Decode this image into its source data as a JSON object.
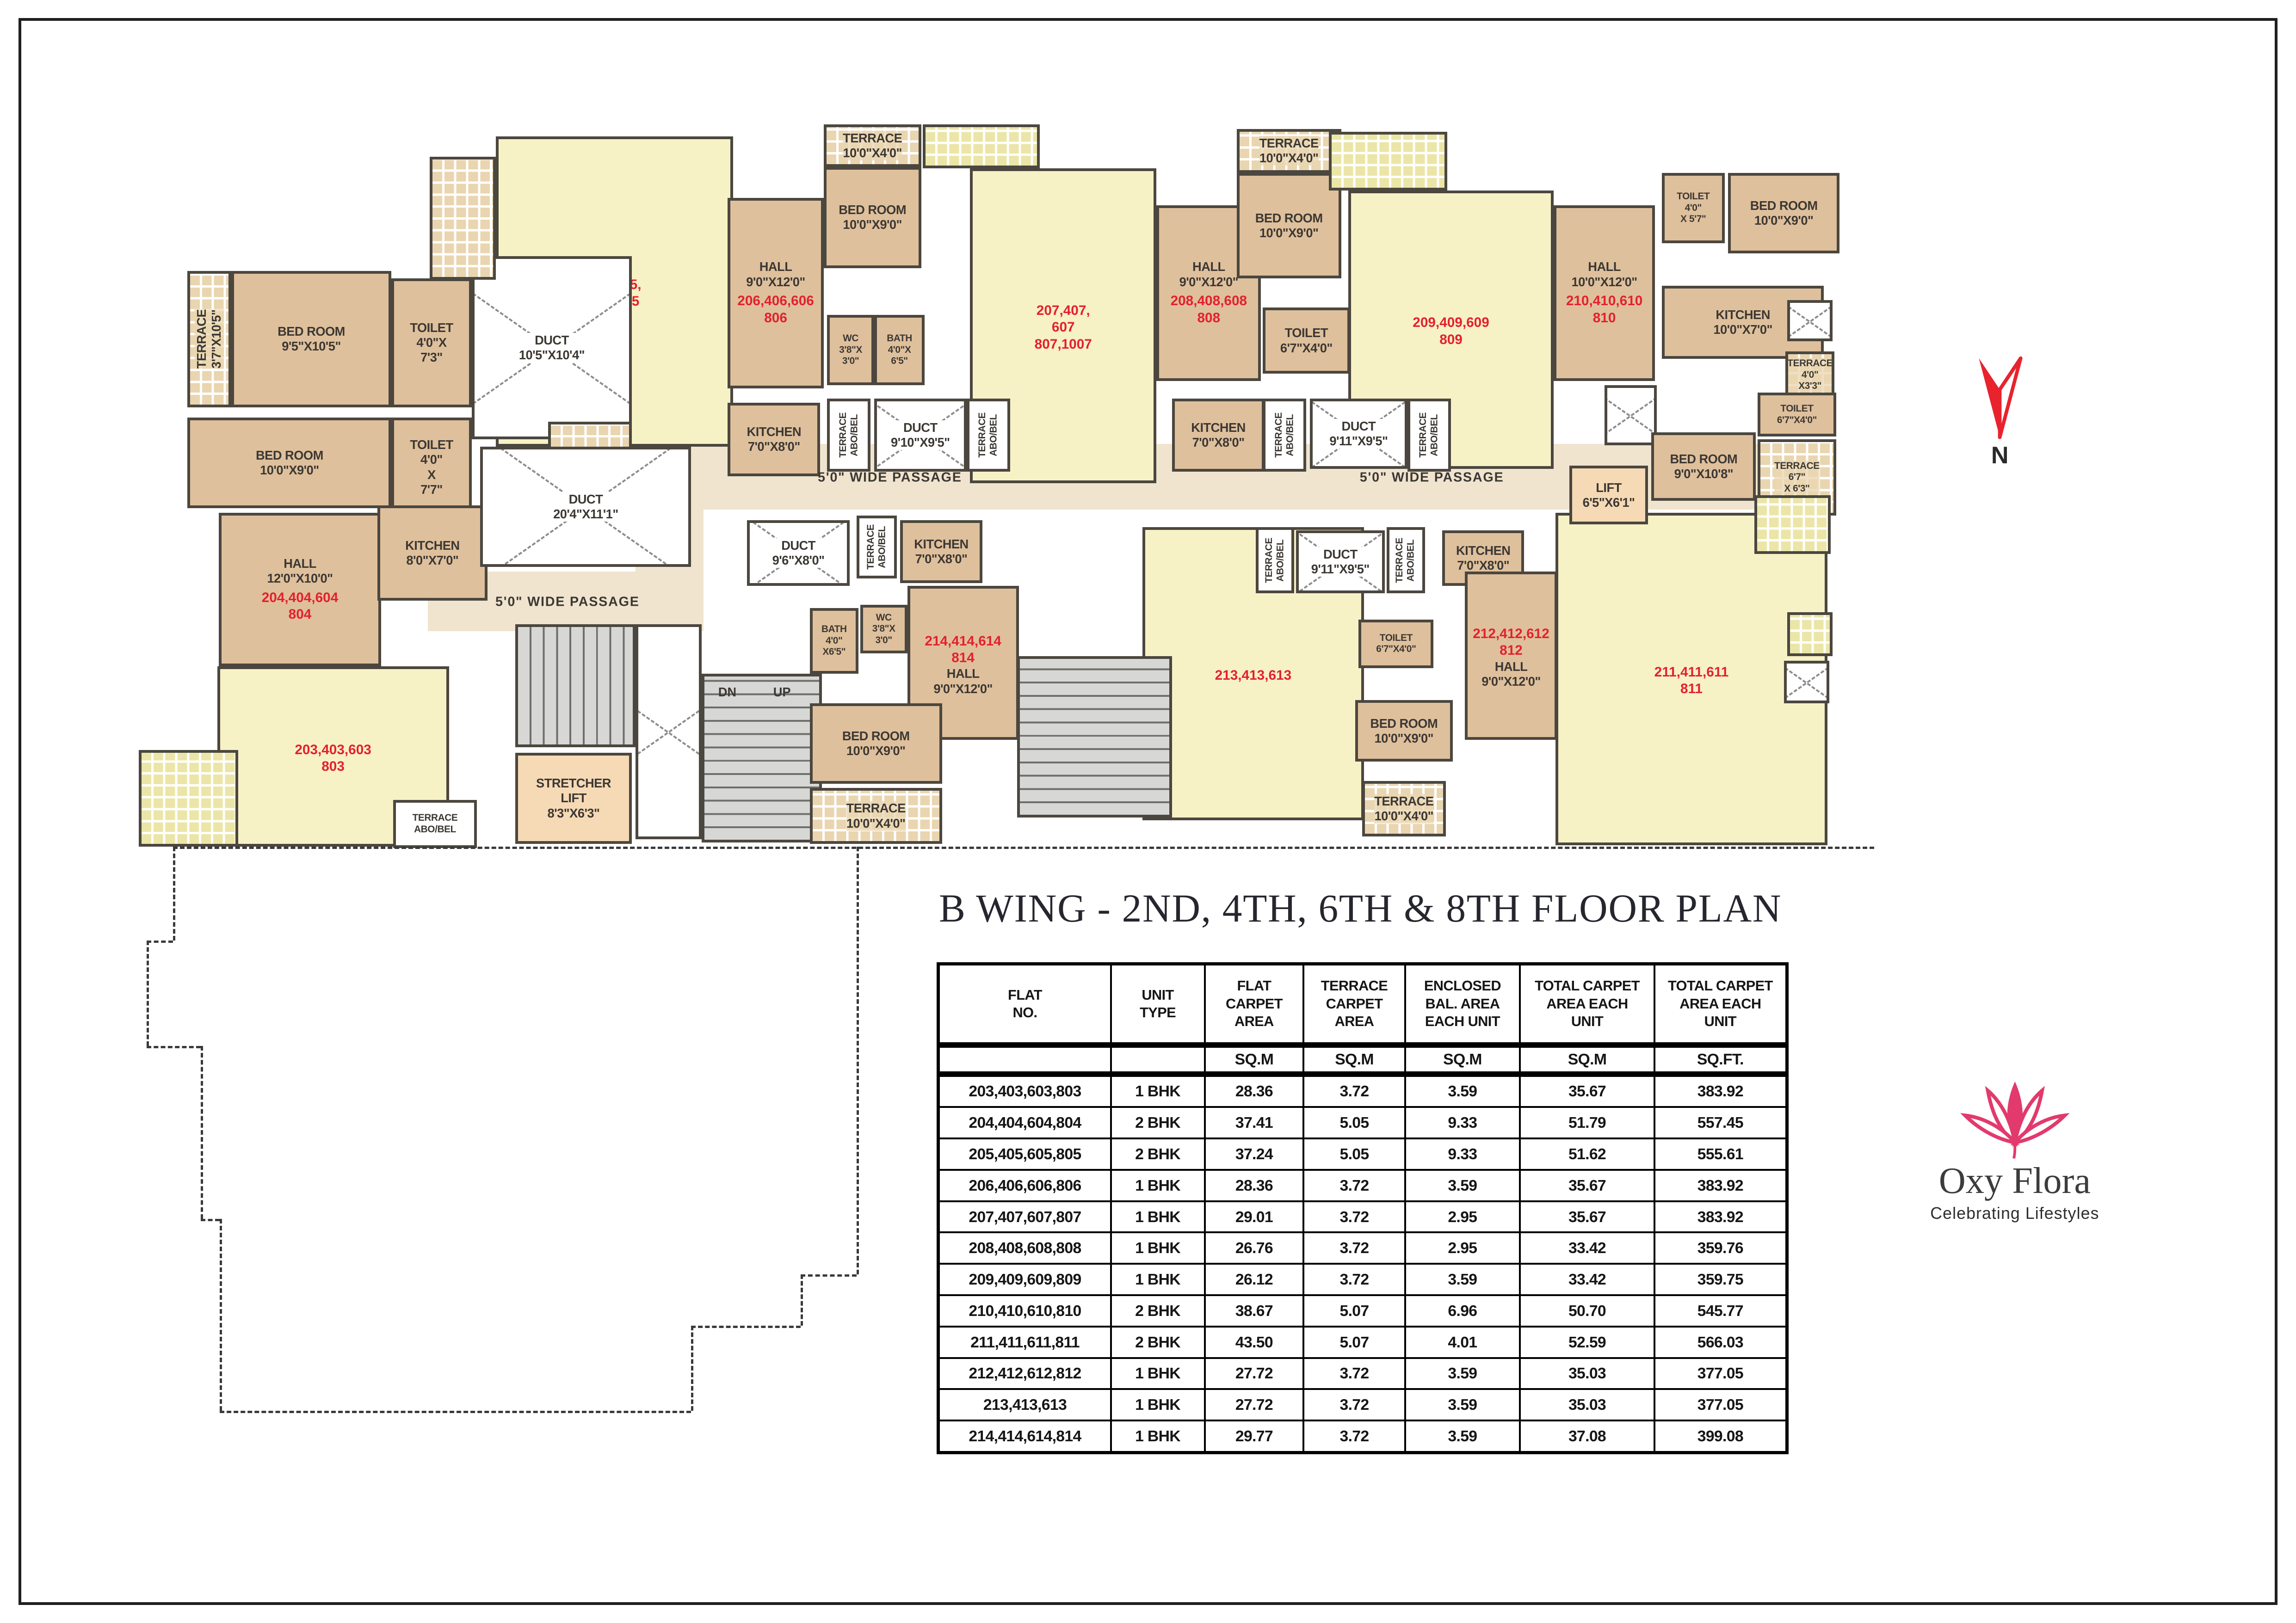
{
  "title": "B WING - 2ND, 4TH, 6TH & 8TH FLOOR PLAN",
  "north": {
    "label": "N"
  },
  "logo": {
    "name": "Oxy Flora",
    "tagline": "Celebrating Lifestyles",
    "accent": "#e23a6d"
  },
  "colors": {
    "flat_red": "#e3212e",
    "wall": "#4b473f",
    "room_tan": "#dfc09c",
    "room_yellow": "#f7f1c6",
    "passage": "#f0e4cf"
  },
  "plan": {
    "zones": [
      {
        "x": 32.7,
        "y": 44.6,
        "w": 64.8,
        "h": 9.0
      },
      {
        "x": 17.0,
        "y": 62.0,
        "w": 15.8,
        "h": 8.2
      },
      {
        "x": 28.9,
        "y": 44.6,
        "w": 3.9,
        "h": 25.5
      }
    ],
    "passages": [
      {
        "text": "5'0\" WIDE PASSAGE",
        "x": 25.0,
        "y": 66.2
      },
      {
        "text": "5'0\" WIDE PASSAGE",
        "x": 43.5,
        "y": 49.2
      },
      {
        "text": "5'0\" WIDE PASSAGE",
        "x": 74.6,
        "y": 49.2
      }
    ],
    "rooms": [
      {
        "id": "flat-203-hall",
        "type": "y",
        "label": "",
        "flat": "203,403,603\n803",
        "flat_first": true,
        "x": 4.9,
        "y": 75.0,
        "w": 13.3,
        "h": 24.6
      },
      {
        "id": "flat-205-hall",
        "type": "y",
        "label": "",
        "flat": "205,405,\n605,805",
        "x": 20.9,
        "y": 2.6,
        "w": 13.6,
        "h": 42.4
      },
      {
        "id": "flat-207-hall",
        "type": "y",
        "label": "",
        "flat": "207,407,\n607\n807,1007",
        "x": 48.1,
        "y": 7.0,
        "w": 10.7,
        "h": 43.0
      },
      {
        "id": "flat-209-hall",
        "type": "y",
        "label": "",
        "flat": "209,409,609\n809",
        "x": 69.8,
        "y": 10.0,
        "w": 11.8,
        "h": 38.0
      },
      {
        "id": "flat-213-hall",
        "type": "y",
        "label": "",
        "flat": "213,413,613",
        "x": 58.0,
        "y": 56.0,
        "w": 12.7,
        "h": 40.0
      },
      {
        "id": "flat-211-hall",
        "type": "y",
        "label": "",
        "flat": "211,411,611\n811",
        "x": 81.7,
        "y": 54.0,
        "w": 15.6,
        "h": 45.4
      },
      {
        "id": "terrace-204",
        "type": "ct",
        "vert": true,
        "label": "TERRACE\n3'7\"X10'5\"",
        "x": 3.2,
        "y": 21.0,
        "w": 2.5,
        "h": 18.6
      },
      {
        "id": "bedroom-204a",
        "type": "t",
        "label": "BED ROOM\n9'5\"X10'5\"",
        "x": 5.7,
        "y": 21.0,
        "w": 9.2,
        "h": 18.6
      },
      {
        "id": "toilet-204a",
        "type": "t",
        "label": "TOILET\n4'0\"X\n7'3\"",
        "x": 14.9,
        "y": 22.0,
        "w": 4.6,
        "h": 17.6
      },
      {
        "id": "duct-204",
        "type": "d",
        "label": "DUCT\n10'5\"X10'4\"",
        "x": 19.5,
        "y": 19.0,
        "w": 9.2,
        "h": 25.0
      },
      {
        "id": "bedroom-204b",
        "type": "t",
        "label": "BED ROOM\n10'0\"X9'0\"",
        "x": 3.2,
        "y": 41.0,
        "w": 11.7,
        "h": 12.4
      },
      {
        "id": "toilet-204b",
        "type": "t",
        "label": "TOILET\n4'0\"\nX\n7'7\"",
        "x": 14.9,
        "y": 41.0,
        "w": 4.6,
        "h": 13.6
      },
      {
        "id": "terrace-204b",
        "type": "ct",
        "sm": true,
        "label": "TERRACE\n3'9\"X\n4'6\"",
        "x": 23.9,
        "y": 41.6,
        "w": 4.8,
        "h": 12.0
      },
      {
        "id": "hall-204",
        "type": "t",
        "label": "HALL\n12'0\"X10'0\"",
        "flat": "204,404,604\n804",
        "x": 5.0,
        "y": 54.0,
        "w": 9.3,
        "h": 21.0
      },
      {
        "id": "kitchen-204",
        "type": "t",
        "label": "KITCHEN\n8'0\"X7'0\"",
        "x": 14.1,
        "y": 53.0,
        "w": 6.3,
        "h": 13.0
      },
      {
        "id": "terrace-203",
        "type": "cy",
        "label": "",
        "x": 0.4,
        "y": 86.4,
        "w": 5.7,
        "h": 13.2
      },
      {
        "id": "terrace-abobel-203",
        "type": "w",
        "label": "TERRACE\nABO/BEL",
        "x": 15.0,
        "y": 93.2,
        "w": 4.8,
        "h": 6.6
      },
      {
        "id": "duct-central",
        "type": "d",
        "label": "DUCT\n20'4\"X11'1\"",
        "x": 20.0,
        "y": 45.0,
        "w": 12.1,
        "h": 16.4
      },
      {
        "id": "stair-a",
        "type": "s",
        "dir": "v",
        "x": 22.0,
        "y": 69.2,
        "w": 6.9,
        "h": 16.8,
        "slabels": [
          {
            "t": "UP",
            "x": -36,
            "y": 12
          },
          {
            "t": "DN",
            "x": -36,
            "y": 64
          }
        ]
      },
      {
        "id": "shaft-a",
        "type": "d",
        "label": "",
        "x": 28.9,
        "y": 69.2,
        "w": 3.8,
        "h": 29.4
      },
      {
        "id": "stretcher-lift",
        "type": "lift",
        "label": "STRETCHER\nLIFT\n8'3\"X6'3\"",
        "x": 22.0,
        "y": 86.8,
        "w": 6.7,
        "h": 12.4
      },
      {
        "id": "stair-b",
        "type": "s",
        "dir": "h",
        "x": 32.7,
        "y": 76.0,
        "w": 6.9,
        "h": 23.0,
        "slabels": [
          {
            "t": "DN",
            "x": 12,
            "y": 5
          },
          {
            "t": "UP",
            "x": 60,
            "y": 5
          }
        ]
      },
      {
        "id": "terrace-205",
        "type": "ct",
        "label": "",
        "x": 17.1,
        "y": 5.4,
        "w": 3.8,
        "h": 16.8
      },
      {
        "id": "hall-206",
        "type": "t",
        "label": "HALL\n9'0\"X12'0\"",
        "flat": "206,406,606\n806",
        "x": 34.2,
        "y": 11.0,
        "w": 5.5,
        "h": 26.0
      },
      {
        "id": "terrace-206",
        "type": "ct",
        "label": "TERRACE\n10'0\"X4'0\"",
        "x": 39.7,
        "y": 1.0,
        "w": 5.6,
        "h": 5.8
      },
      {
        "id": "bedroom-206",
        "type": "t",
        "label": "BED ROOM\n10'0\"X9'0\"",
        "x": 39.7,
        "y": 6.8,
        "w": 5.6,
        "h": 13.8
      },
      {
        "id": "wc-206",
        "type": "t",
        "sm": true,
        "label": "WC\n3'8\"X\n3'0\"",
        "x": 39.9,
        "y": 27.0,
        "w": 2.7,
        "h": 9.6
      },
      {
        "id": "bath-206",
        "type": "t",
        "sm": true,
        "label": "BATH\n4'0\"X\n6'5\"",
        "x": 42.6,
        "y": 27.0,
        "w": 2.9,
        "h": 9.6
      },
      {
        "id": "duct-206",
        "type": "d",
        "label": "DUCT\n9'10\"X9'5\"",
        "x": 42.6,
        "y": 38.4,
        "w": 5.3,
        "h": 10.0
      },
      {
        "id": "terrace-abobel-206l",
        "type": "w",
        "vert": true,
        "label": "TERRACE\nABO/BEL",
        "x": 39.9,
        "y": 38.4,
        "w": 2.5,
        "h": 10.0
      },
      {
        "id": "terrace-abobel-206r",
        "type": "w",
        "vert": true,
        "label": "TERRACE\nABO/BEL",
        "x": 47.9,
        "y": 38.4,
        "w": 2.5,
        "h": 10.0
      },
      {
        "id": "kitchen-206",
        "type": "t",
        "label": "KITCHEN\n7'0\"X8'0\"",
        "x": 34.2,
        "y": 39.0,
        "w": 5.3,
        "h": 10.0
      },
      {
        "id": "terrace-207",
        "type": "cy",
        "label": "",
        "x": 45.4,
        "y": 1.0,
        "w": 6.7,
        "h": 6.0
      },
      {
        "id": "hall-208",
        "type": "t",
        "label": "HALL\n9'0\"X12'0\"",
        "flat": "208,408,608\n808",
        "x": 58.8,
        "y": 12.0,
        "w": 6.0,
        "h": 24.0
      },
      {
        "id": "terrace-208",
        "type": "ct",
        "label": "TERRACE\n10'0\"X4'0\"",
        "x": 63.4,
        "y": 1.6,
        "w": 6.0,
        "h": 6.0
      },
      {
        "id": "bedroom-208",
        "type": "t",
        "label": "BED ROOM\n10'0\"X9'0\"",
        "x": 63.4,
        "y": 7.6,
        "w": 6.0,
        "h": 14.4
      },
      {
        "id": "toilet-208",
        "type": "t",
        "label": "TOILET\n6'7\"X4'0\"",
        "x": 64.9,
        "y": 26.0,
        "w": 5.0,
        "h": 9.0
      },
      {
        "id": "kitchen-208",
        "type": "t",
        "label": "KITCHEN\n7'0\"X8'0\"",
        "x": 59.7,
        "y": 38.4,
        "w": 5.3,
        "h": 10.0
      },
      {
        "id": "duct-208",
        "type": "d",
        "label": "DUCT\n9'11\"X9'5\"",
        "x": 67.6,
        "y": 38.4,
        "w": 5.6,
        "h": 9.6
      },
      {
        "id": "terrace-abobel-208l",
        "type": "w",
        "vert": true,
        "label": "TERRACE\nABO/BEL",
        "x": 64.9,
        "y": 38.4,
        "w": 2.5,
        "h": 10.0
      },
      {
        "id": "terrace-abobel-208r",
        "type": "w",
        "vert": true,
        "label": "TERRACE\nABO/BEL",
        "x": 73.2,
        "y": 38.4,
        "w": 2.5,
        "h": 10.0
      },
      {
        "id": "terrace-209",
        "type": "cy",
        "label": "",
        "x": 68.7,
        "y": 2.0,
        "w": 6.8,
        "h": 8.0
      },
      {
        "id": "hall-210",
        "type": "t",
        "label": "HALL\n10'0\"X12'0\"",
        "flat": "210,410,610\n810",
        "x": 81.6,
        "y": 12.0,
        "w": 5.8,
        "h": 24.0
      },
      {
        "id": "toilet-210a",
        "type": "t",
        "sm": true,
        "label": "TOILET\n4'0\"\nX 5'7\"",
        "x": 87.8,
        "y": 7.6,
        "w": 3.6,
        "h": 9.6
      },
      {
        "id": "bedroom-210a",
        "type": "t",
        "label": "BED ROOM\n10'0\"X9'0\"",
        "x": 91.6,
        "y": 7.6,
        "w": 6.4,
        "h": 11.0
      },
      {
        "id": "kitchen-210",
        "type": "t",
        "label": "KITCHEN\n10'0\"X7'0\"",
        "x": 87.8,
        "y": 23.0,
        "w": 9.3,
        "h": 10.0
      },
      {
        "id": "duct-210b",
        "type": "d",
        "label": "",
        "x": 95.0,
        "y": 25.0,
        "w": 2.6,
        "h": 5.6
      },
      {
        "id": "terrace-210s",
        "type": "ct",
        "sm": true,
        "label": "TERRACE\n4'0\"\nX3'3\"",
        "x": 94.9,
        "y": 32.0,
        "w": 2.8,
        "h": 6.4
      },
      {
        "id": "duct-210a",
        "type": "d",
        "label": "",
        "x": 84.5,
        "y": 36.6,
        "w": 3.0,
        "h": 8.2
      },
      {
        "id": "toilet-210b",
        "type": "t",
        "sm": true,
        "label": "TOILET\n6'7\"X4'0\"",
        "x": 93.3,
        "y": 37.6,
        "w": 4.5,
        "h": 6.0
      },
      {
        "id": "terrace-210b",
        "type": "ct",
        "sm": true,
        "label": "TERRACE\n6'7\"\nX 6'3\"",
        "x": 93.3,
        "y": 44.0,
        "w": 4.5,
        "h": 10.4
      },
      {
        "id": "bedroom-210b",
        "type": "t",
        "label": "BED ROOM\n9'0\"X10'8\"",
        "x": 87.2,
        "y": 43.0,
        "w": 6.0,
        "h": 9.4
      },
      {
        "id": "lift",
        "type": "lift",
        "label": "LIFT\n6'5\"X6'1\"",
        "x": 82.5,
        "y": 47.6,
        "w": 4.5,
        "h": 8.0
      },
      {
        "id": "duct-214",
        "type": "d",
        "label": "DUCT\n9'6\"X8'0\"",
        "x": 35.3,
        "y": 55.0,
        "w": 5.9,
        "h": 9.0
      },
      {
        "id": "terrace-abobel-214",
        "type": "w",
        "vert": true,
        "label": "TERRACE\nABO/BEL",
        "x": 41.6,
        "y": 54.4,
        "w": 2.3,
        "h": 8.6
      },
      {
        "id": "kitchen-214",
        "type": "t",
        "label": "KITCHEN\n7'0\"X8'0\"",
        "x": 44.1,
        "y": 55.0,
        "w": 4.7,
        "h": 8.6
      },
      {
        "id": "bath-214",
        "type": "t",
        "sm": true,
        "label": "BATH\n4'0\"\nX6'5\"",
        "x": 38.9,
        "y": 67.0,
        "w": 2.8,
        "h": 9.0
      },
      {
        "id": "wc-214",
        "type": "t",
        "sm": true,
        "label": "WC\n3'8\"X\n3'0\"",
        "x": 41.8,
        "y": 66.6,
        "w": 2.7,
        "h": 6.6
      },
      {
        "id": "hall-214",
        "type": "t",
        "label": "HALL\n9'0\"X12'0\"",
        "flat": "214,414,614\n814",
        "flat_first": true,
        "x": 44.5,
        "y": 64.0,
        "w": 6.4,
        "h": 21.0
      },
      {
        "id": "bedroom-214",
        "type": "t",
        "label": "BED ROOM\n10'0\"X9'0\"",
        "x": 38.9,
        "y": 80.0,
        "w": 7.6,
        "h": 11.0
      },
      {
        "id": "terrace-214",
        "type": "ct",
        "label": "TERRACE\n10'0\"X4'0\"",
        "x": 38.9,
        "y": 91.6,
        "w": 7.6,
        "h": 7.6
      },
      {
        "id": "stair-c",
        "type": "s",
        "dir": "h",
        "x": 50.8,
        "y": 73.6,
        "w": 8.9,
        "h": 22.0,
        "slabels": [
          {
            "t": "DN",
            "x": 15,
            "y": -14
          },
          {
            "t": "UP",
            "x": 62,
            "y": -14
          }
        ]
      },
      {
        "id": "duct-213",
        "type": "d",
        "label": "DUCT\n9'11\"X9'5\"",
        "x": 66.8,
        "y": 56.4,
        "w": 5.1,
        "h": 8.6
      },
      {
        "id": "terrace-abobel-213l",
        "type": "w",
        "vert": true,
        "label": "TERRACE\nABO/BEL",
        "x": 64.5,
        "y": 56.0,
        "w": 2.2,
        "h": 9.0
      },
      {
        "id": "terrace-abobel-213r",
        "type": "w",
        "vert": true,
        "label": "TERRACE\nABO/BEL",
        "x": 72.0,
        "y": 56.0,
        "w": 2.2,
        "h": 9.0
      },
      {
        "id": "kitchen-212",
        "type": "t",
        "label": "KITCHEN\n7'0\"X8'0\"",
        "x": 75.2,
        "y": 56.4,
        "w": 4.7,
        "h": 7.6
      },
      {
        "id": "toilet-212",
        "type": "t",
        "sm": true,
        "label": "TOILET\n6'7\"X4'0\"",
        "x": 70.4,
        "y": 68.6,
        "w": 4.3,
        "h": 6.6
      },
      {
        "id": "hall-212",
        "type": "t",
        "label": "HALL\n9'0\"X12'0\"",
        "flat": "212,412,612\n812",
        "flat_first": true,
        "x": 76.5,
        "y": 62.0,
        "w": 5.3,
        "h": 23.0
      },
      {
        "id": "bedroom-212",
        "type": "t",
        "label": "BED ROOM\n10'0\"X9'0\"",
        "x": 70.2,
        "y": 79.6,
        "w": 5.6,
        "h": 8.4
      },
      {
        "id": "terrace-212",
        "type": "ct",
        "label": "TERRACE\n10'0\"X4'0\"",
        "x": 70.6,
        "y": 90.6,
        "w": 4.8,
        "h": 7.6
      },
      {
        "id": "terrace-211a",
        "type": "cy",
        "label": "",
        "x": 93.1,
        "y": 51.6,
        "w": 4.4,
        "h": 8.0
      },
      {
        "id": "terrace-211b",
        "type": "cy",
        "label": "",
        "x": 95.0,
        "y": 67.6,
        "w": 2.6,
        "h": 6.0
      },
      {
        "id": "duct-211",
        "type": "d",
        "label": "",
        "x": 94.8,
        "y": 74.2,
        "w": 2.6,
        "h": 5.8
      }
    ],
    "outline": [
      {
        "x": 7.53,
        "y": 52.17,
        "w": 74.1
      },
      {
        "x": 7.53,
        "y": 52.17,
        "h": 5.77
      },
      {
        "x": 6.38,
        "y": 57.94,
        "w": 1.15
      },
      {
        "x": 6.38,
        "y": 57.94,
        "h": 6.5
      },
      {
        "x": 6.38,
        "y": 64.44,
        "w": 2.36
      },
      {
        "x": 8.74,
        "y": 64.44,
        "h": 10.65
      },
      {
        "x": 8.74,
        "y": 75.09,
        "w": 0.83
      },
      {
        "x": 9.57,
        "y": 75.09,
        "h": 11.82
      },
      {
        "x": 9.57,
        "y": 86.91,
        "w": 20.53
      },
      {
        "x": 30.1,
        "y": 81.68,
        "h": 5.23
      },
      {
        "x": 30.1,
        "y": 81.68,
        "w": 4.78
      },
      {
        "x": 34.88,
        "y": 78.52,
        "h": 3.16
      },
      {
        "x": 34.88,
        "y": 78.52,
        "w": 2.43
      },
      {
        "x": 37.31,
        "y": 52.17,
        "h": 26.35
      }
    ]
  },
  "table": {
    "col_widths": [
      20.1,
      11.1,
      11.7,
      12.0,
      13.6,
      15.9,
      15.6
    ],
    "headers": [
      "FLAT\nNO.",
      "UNIT\nTYPE",
      "FLAT\nCARPET\nAREA",
      "TERRACE\nCARPET\nAREA",
      "ENCLOSED\nBAL. AREA\nEACH UNIT",
      "TOTAL CARPET\nAREA EACH\nUNIT",
      "TOTAL CARPET\nAREA EACH\nUNIT"
    ],
    "units": [
      "",
      "",
      "SQ.M",
      "SQ.M",
      "SQ.M",
      "SQ.M",
      "SQ.FT."
    ],
    "rows": [
      [
        "203,403,603,803",
        "1 BHK",
        "28.36",
        "3.72",
        "3.59",
        "35.67",
        "383.92"
      ],
      [
        "204,404,604,804",
        "2 BHK",
        "37.41",
        "5.05",
        "9.33",
        "51.79",
        "557.45"
      ],
      [
        "205,405,605,805",
        "2 BHK",
        "37.24",
        "5.05",
        "9.33",
        "51.62",
        "555.61"
      ],
      [
        "206,406,606,806",
        "1 BHK",
        "28.36",
        "3.72",
        "3.59",
        "35.67",
        "383.92"
      ],
      [
        "207,407,607,807",
        "1 BHK",
        "29.01",
        "3.72",
        "2.95",
        "35.67",
        "383.92"
      ],
      [
        "208,408,608,808",
        "1 BHK",
        "26.76",
        "3.72",
        "2.95",
        "33.42",
        "359.76"
      ],
      [
        "209,409,609,809",
        "1 BHK",
        "26.12",
        "3.72",
        "3.59",
        "33.42",
        "359.75"
      ],
      [
        "210,410,610,810",
        "2 BHK",
        "38.67",
        "5.07",
        "6.96",
        "50.70",
        "545.77"
      ],
      [
        "211,411,611,811",
        "2 BHK",
        "43.50",
        "5.07",
        "4.01",
        "52.59",
        "566.03"
      ],
      [
        "212,412,612,812",
        "1 BHK",
        "27.72",
        "3.72",
        "3.59",
        "35.03",
        "377.05"
      ],
      [
        "213,413,613",
        "1 BHK",
        "27.72",
        "3.72",
        "3.59",
        "35.03",
        "377.05"
      ],
      [
        "214,414,614,814",
        "1 BHK",
        "29.77",
        "3.72",
        "3.59",
        "37.08",
        "399.08"
      ]
    ]
  }
}
